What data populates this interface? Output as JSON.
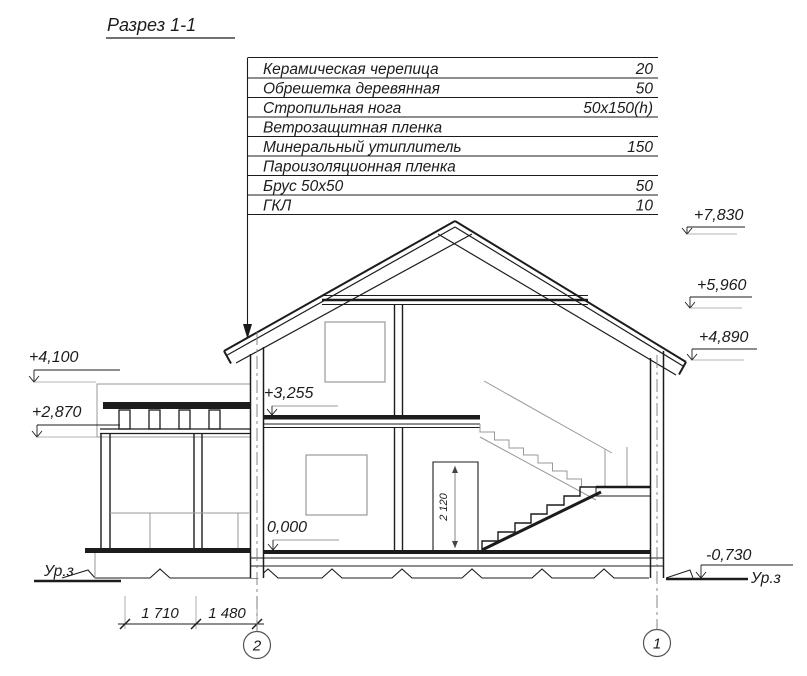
{
  "title": "Разрез 1-1",
  "layers_table": {
    "rows": [
      {
        "label": "Керамическая черепица",
        "value": "20"
      },
      {
        "label": "Обрешетка деревянная",
        "value": "50"
      },
      {
        "label": "Стропильная нога",
        "value": "50x150(h)"
      },
      {
        "label": "Ветрозащитная пленка",
        "value": ""
      },
      {
        "label": "Минеральный утиплитель",
        "value": "150"
      },
      {
        "label": "Пароизоляционная пленка",
        "value": ""
      },
      {
        "label": "Брус 50x50",
        "value": "50"
      },
      {
        "label": "ГКЛ",
        "value": "10"
      }
    ]
  },
  "elevations": {
    "roof_ridge": "+7,830",
    "attic_ceiling": "+5,960",
    "eave": "+4,890",
    "porch_roof_top": "+4,100",
    "porch_beam": "+2,870",
    "second_floor": "+3,255",
    "ground_floor": "0,000",
    "ground_level": "-0,730"
  },
  "ground_labels": {
    "left": "Ур.з",
    "right": "Ур.з"
  },
  "dimensions": {
    "span_left": "1 710",
    "span_right": "1 480",
    "door_height": "2 120"
  },
  "axes": {
    "axis_2": "2",
    "axis_1": "1"
  }
}
